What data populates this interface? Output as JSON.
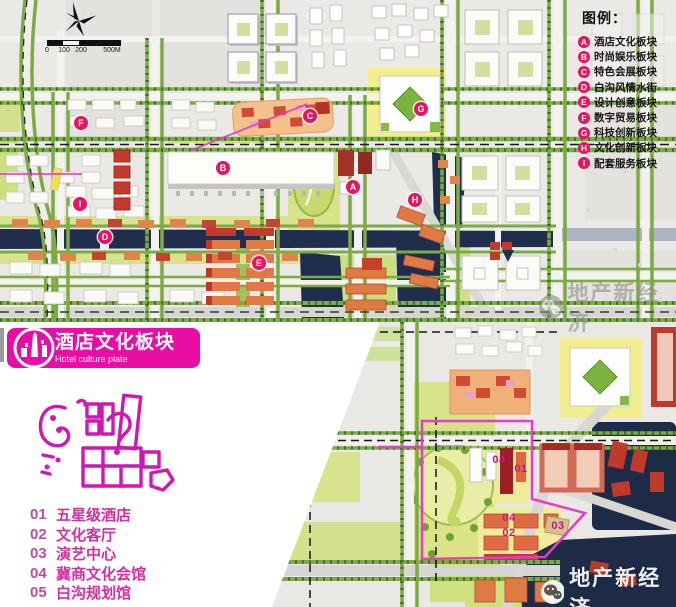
{
  "legend": {
    "title": "图例：",
    "items": [
      {
        "key": "A",
        "label": "酒店文化板块"
      },
      {
        "key": "B",
        "label": "时尚娱乐板块"
      },
      {
        "key": "C",
        "label": "特色会展板块"
      },
      {
        "key": "D",
        "label": "白沟风情水街"
      },
      {
        "key": "E",
        "label": "设计创意板块"
      },
      {
        "key": "F",
        "label": "数字贸易板块"
      },
      {
        "key": "G",
        "label": "科技创新板块"
      },
      {
        "key": "H",
        "label": "文化创新板块"
      },
      {
        "key": "I",
        "label": "配套服务板块"
      }
    ]
  },
  "map_markers": [
    {
      "label": "A",
      "x": 353,
      "y": 187
    },
    {
      "label": "B",
      "x": 223,
      "y": 168
    },
    {
      "label": "C",
      "x": 310,
      "y": 116
    },
    {
      "label": "D",
      "x": 105,
      "y": 237
    },
    {
      "label": "E",
      "x": 259,
      "y": 263
    },
    {
      "label": "F",
      "x": 81,
      "y": 123
    },
    {
      "label": "G",
      "x": 421,
      "y": 109
    },
    {
      "label": "H",
      "x": 415,
      "y": 200
    },
    {
      "label": "I",
      "x": 80,
      "y": 204
    }
  ],
  "detail_labels": [
    {
      "label": "04",
      "x": 499,
      "y": 460
    },
    {
      "label": "01",
      "x": 521,
      "y": 469
    },
    {
      "label": "04",
      "x": 509,
      "y": 518
    },
    {
      "label": "02",
      "x": 509,
      "y": 533
    },
    {
      "label": "03",
      "x": 558,
      "y": 526
    }
  ],
  "scale_bar": {
    "labels": [
      "0",
      "100",
      "200",
      "500M"
    ],
    "xs": [
      47,
      64,
      81,
      112
    ]
  },
  "plate_banner": {
    "title": "酒店文化板块",
    "subtitle": "Hotel culture plate"
  },
  "plate_list": [
    {
      "num": "01",
      "label": "五星级酒店"
    },
    {
      "num": "02",
      "label": "文化客厅"
    },
    {
      "num": "03",
      "label": "演艺中心"
    },
    {
      "num": "04",
      "label": "冀商文化会馆"
    },
    {
      "num": "05",
      "label": "白沟规划馆"
    }
  ],
  "watermark": {
    "text": "地产新经济"
  },
  "colors": {
    "marker_red": "#e8145f",
    "banner_pink": "#e90da6",
    "list_num_pink": "#b94fa3",
    "list_label_pink": "#d62ea0",
    "boundary_magenta": "#e53dc5",
    "detail_label_magenta": "#c4178c",
    "water_navy": "#1d2b47",
    "street_green": "#7cab45",
    "legend_text": "#161616"
  }
}
